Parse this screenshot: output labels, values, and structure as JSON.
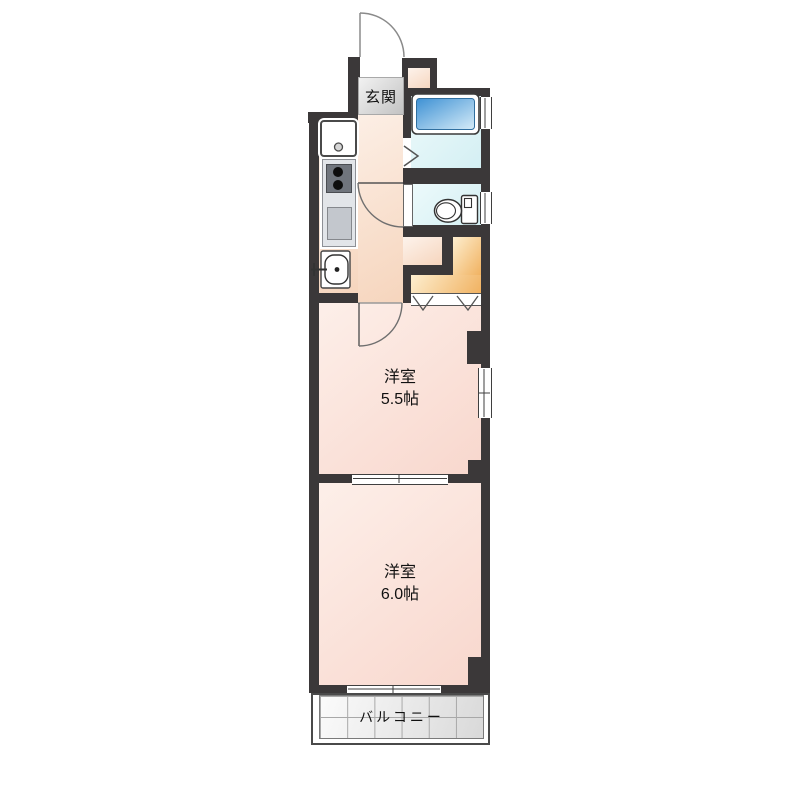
{
  "plan": {
    "labels": {
      "entrance": "玄関",
      "balcony": "バルコニー"
    },
    "rooms": [
      {
        "name": "洋室",
        "size": "5.5帖"
      },
      {
        "name": "洋室",
        "size": "6.0帖"
      }
    ],
    "icons": [
      "entrance-door-swing-icon",
      "hall-door-swing-icon",
      "room-door-swing-icon",
      "bath-folding-door-icon",
      "closet-bifold-door-icon",
      "bathtub-icon",
      "toilet-icon",
      "washbasin-icon",
      "stove-burners-icon",
      "kitchen-sink-icon",
      "washing-machine-pan-icon",
      "sliding-window-icon"
    ],
    "colors": {
      "wall": "#3b3839",
      "hall-floor-light": "#fdf3ec",
      "hall-floor-dark": "#f6d5bd",
      "room-floor-light": "#fdefe9",
      "room-floor-dark": "#f8d7cd",
      "closet-light": "#fdeecf",
      "closet-dark": "#f1b261",
      "genkan-light": "#f2f2f2",
      "genkan-dark": "#c3c3c3",
      "tub-dark": "#3e91d4",
      "tub-light": "#d6ecf8",
      "balcony-tile-light": "#fbfbfb",
      "balcony-tile-dark": "#d9d9d9"
    }
  }
}
